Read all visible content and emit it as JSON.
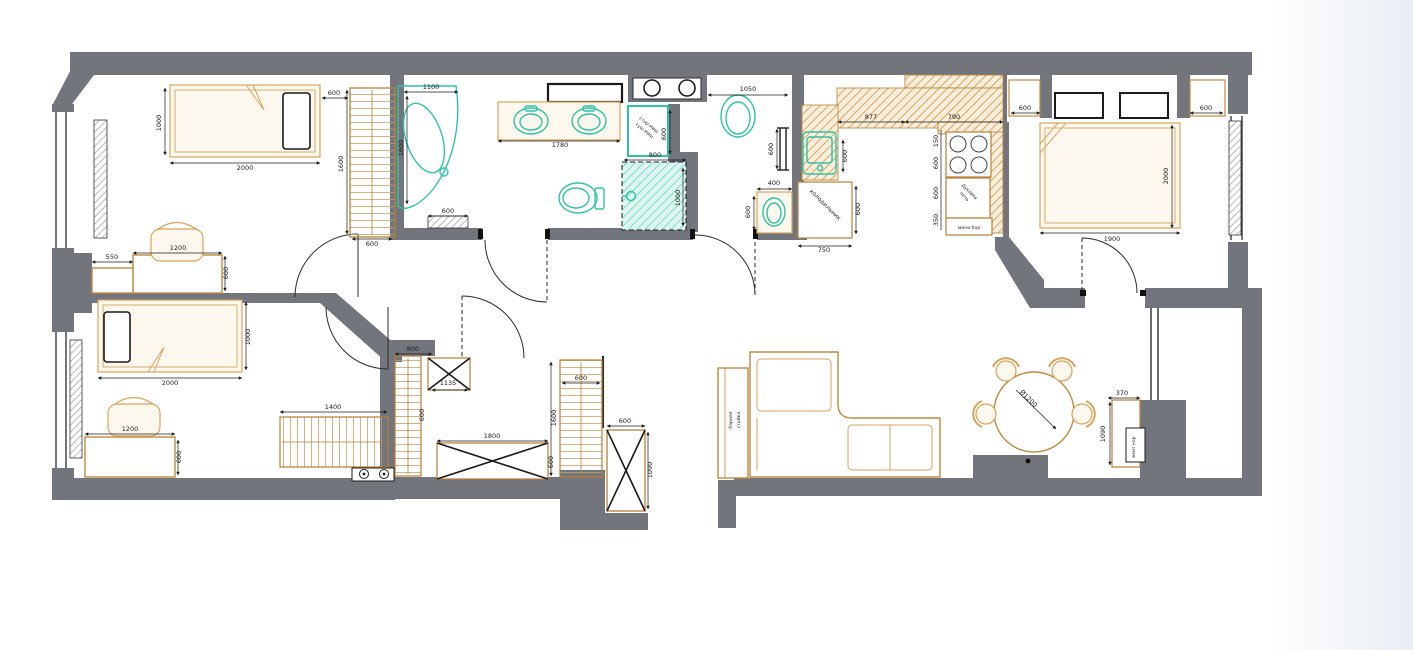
{
  "palette": {
    "wall": "#72757b",
    "furniture_outline": "#c08a3e",
    "sanitary_teal": "#2fc3a6",
    "dimension_text": "#1b1b1b",
    "background": "#ffffff",
    "right_margin_tint": "#e8edf4"
  },
  "fixtures": {
    "washer": "стир маш",
    "dryer": "суш маш",
    "fridge": "холодильник",
    "oven_line1": "Духовка",
    "oven_line2": "печь",
    "minibar": "мини бар",
    "bar_line1": "барная",
    "bar_line2": "стойка",
    "table_diameter": "Ø1200",
    "vent": "вент кор"
  },
  "dimensions": [
    {
      "t": "1000",
      "x": 161,
      "y": 123,
      "r": -90
    },
    {
      "t": "2000",
      "x": 245,
      "y": 170
    },
    {
      "t": "600",
      "x": 334,
      "y": 95
    },
    {
      "t": "1600",
      "x": 343,
      "y": 164,
      "r": -90
    },
    {
      "t": "600",
      "x": 372,
      "y": 246
    },
    {
      "t": "1200",
      "x": 178,
      "y": 250
    },
    {
      "t": "550",
      "x": 112,
      "y": 259
    },
    {
      "t": "600",
      "x": 228,
      "y": 273,
      "r": -90
    },
    {
      "t": "1100",
      "x": 431,
      "y": 89
    },
    {
      "t": "1600",
      "x": 403,
      "y": 148,
      "r": -90
    },
    {
      "t": "600",
      "x": 448,
      "y": 213
    },
    {
      "t": "1780",
      "x": 560,
      "y": 147
    },
    {
      "t": "600",
      "x": 666,
      "y": 134,
      "r": -90
    },
    {
      "t": "800",
      "x": 655,
      "y": 157
    },
    {
      "t": "1000",
      "x": 680,
      "y": 198,
      "r": -90
    },
    {
      "t": "1050",
      "x": 748,
      "y": 91
    },
    {
      "t": "600",
      "x": 773,
      "y": 149,
      "r": -90
    },
    {
      "t": "400",
      "x": 774,
      "y": 185
    },
    {
      "t": "600",
      "x": 750,
      "y": 212,
      "r": -90
    },
    {
      "t": "877",
      "x": 871,
      "y": 119
    },
    {
      "t": "790",
      "x": 954,
      "y": 119
    },
    {
      "t": "600",
      "x": 847,
      "y": 156,
      "r": -90
    },
    {
      "t": "600",
      "x": 860,
      "y": 209,
      "r": -90
    },
    {
      "t": "750",
      "x": 824,
      "y": 252
    },
    {
      "t": "150",
      "x": 938,
      "y": 141,
      "r": -90
    },
    {
      "t": "600",
      "x": 938,
      "y": 163,
      "r": -90
    },
    {
      "t": "600",
      "x": 938,
      "y": 193,
      "r": -90
    },
    {
      "t": "350",
      "x": 938,
      "y": 220,
      "r": -90
    },
    {
      "t": "600",
      "x": 1025,
      "y": 110
    },
    {
      "t": "600",
      "x": 1206,
      "y": 110
    },
    {
      "t": "1900",
      "x": 1112,
      "y": 241
    },
    {
      "t": "2000",
      "x": 1168,
      "y": 176,
      "r": -90
    },
    {
      "t": "800",
      "x": 413,
      "y": 351
    },
    {
      "t": "1135",
      "x": 448,
      "y": 385
    },
    {
      "t": "600",
      "x": 424,
      "y": 415,
      "r": -90
    },
    {
      "t": "1800",
      "x": 492,
      "y": 438
    },
    {
      "t": "600",
      "x": 553,
      "y": 462,
      "r": -90
    },
    {
      "t": "1600",
      "x": 556,
      "y": 418,
      "r": -90
    },
    {
      "t": "600",
      "x": 581,
      "y": 380
    },
    {
      "t": "600",
      "x": 625,
      "y": 423
    },
    {
      "t": "1090",
      "x": 652,
      "y": 470,
      "r": -90
    },
    {
      "t": "2000",
      "x": 170,
      "y": 385
    },
    {
      "t": "1000",
      "x": 250,
      "y": 337,
      "r": -90
    },
    {
      "t": "1200",
      "x": 130,
      "y": 431
    },
    {
      "t": "600",
      "x": 181,
      "y": 457,
      "r": -90
    },
    {
      "t": "1400",
      "x": 333,
      "y": 409
    },
    {
      "t": "370",
      "x": 1122,
      "y": 395
    },
    {
      "t": "1090",
      "x": 1105,
      "y": 434,
      "r": -90
    }
  ]
}
